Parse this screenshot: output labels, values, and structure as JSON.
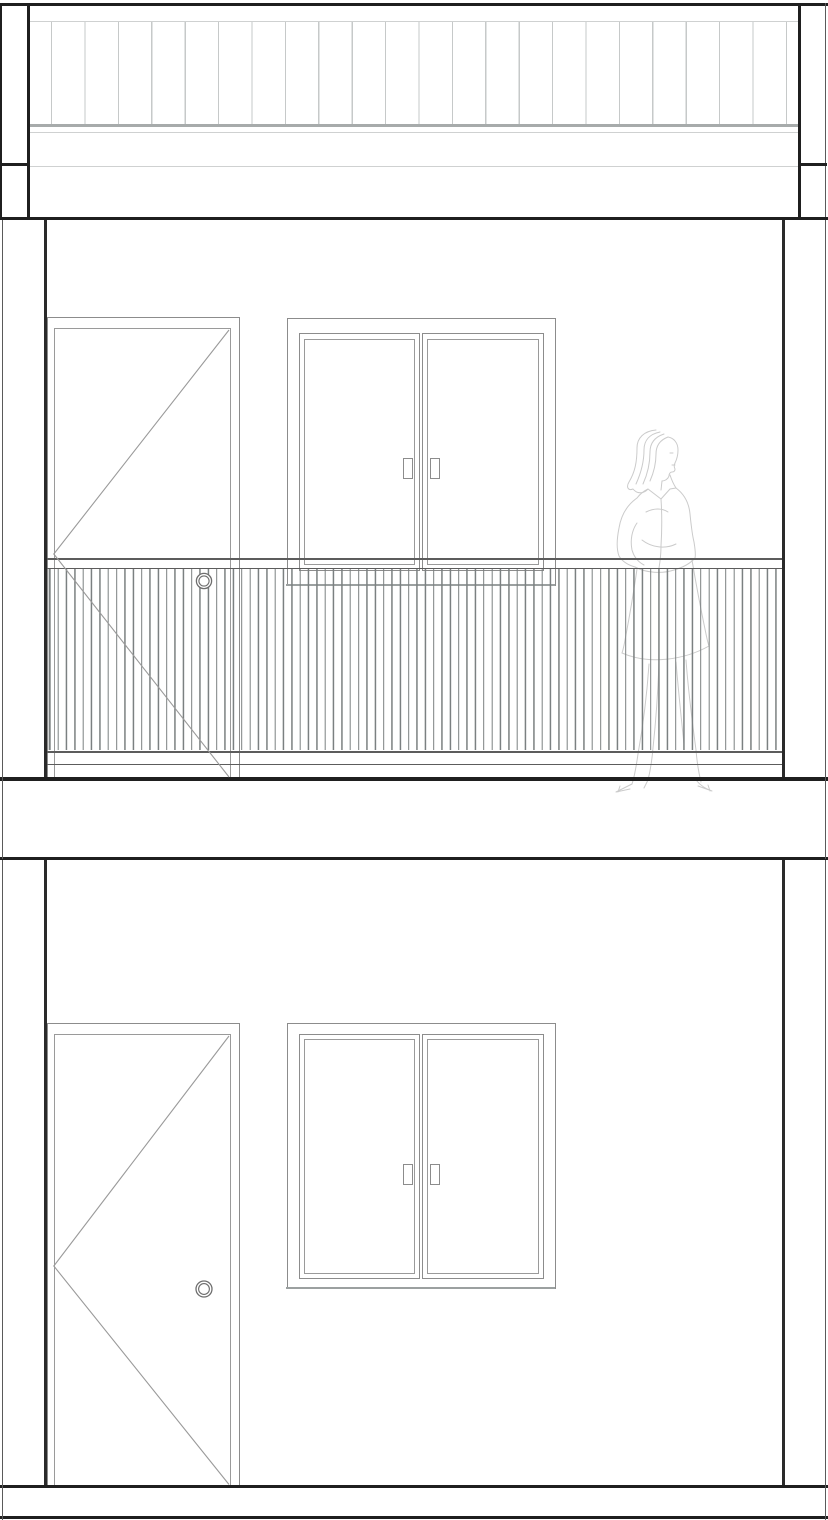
{
  "document": {
    "kind": "architectural elevation drawing",
    "storeys": 2,
    "visible_text": "",
    "background": "#ffffff"
  },
  "palette": {
    "heavy": "#1f1f1f",
    "wall": "#2a2a2a",
    "edge": "#5a5a5a",
    "frame": "#8c8c8c",
    "frame2": "#9a9a9a",
    "rail": "#5c5c5c",
    "baluster": "#7b8081",
    "slat": "#c6c9c9",
    "slatband": "#a7abab",
    "hairline": "#cfd1d1",
    "sill": "#9ba0a0",
    "knob": "#6e6e6e",
    "figure": "#cbcbcb"
  },
  "roof": {
    "name": "roof fascia with vertical cladding slats",
    "slat_count": 23,
    "slat_spacing_px": 33.4,
    "slat_line_px": 1.2,
    "corner_posts": 2
  },
  "upper_floor": {
    "door": {
      "type": "hinged door",
      "swing_marker": "chevron pointing to hinge side",
      "knob": "double circle"
    },
    "window": {
      "type": "double casement window",
      "leaves": 2,
      "handles": 2
    },
    "balcony_railing": {
      "baluster_count": 88,
      "baluster_spacing_px": 8.345,
      "baluster_line_px": 1.3,
      "top_rails": 2,
      "bottom_rails": 2
    },
    "figure": {
      "type": "standing woman, hand on hip",
      "style": "light outline entourage"
    }
  },
  "lower_floor": {
    "door": {
      "type": "hinged door",
      "swing_marker": "chevron pointing to hinge side",
      "knob": "double circle"
    },
    "window": {
      "type": "double casement window",
      "leaves": 2,
      "handles": 2
    }
  },
  "bands": {
    "intermediate_floor_slab": "solid band between storeys",
    "ground_slab": "solid band at base"
  }
}
